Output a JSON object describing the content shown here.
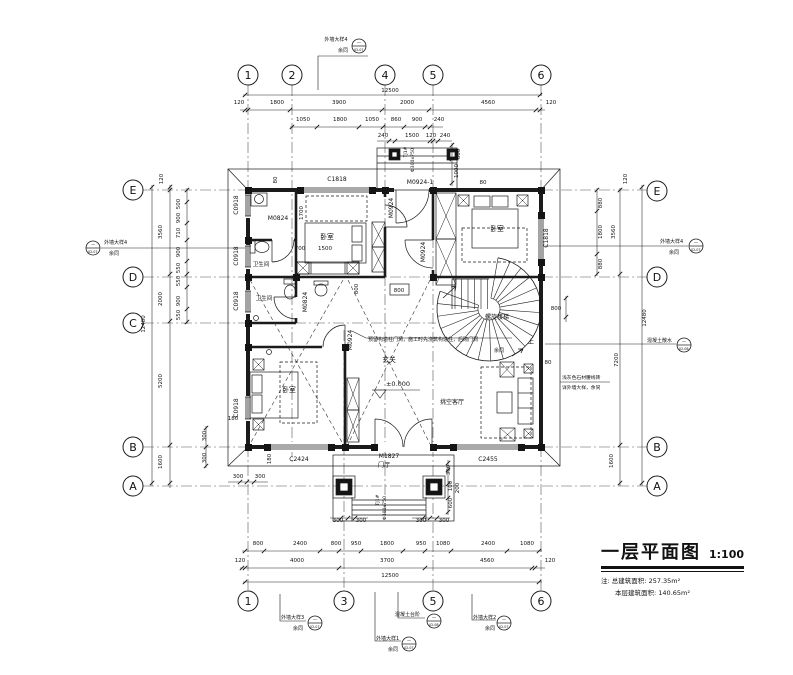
{
  "title_block": {
    "title": "一层平面图",
    "scale": "1:100",
    "note_prefix": "注:",
    "area1_label": "总建筑面积:",
    "area1_value": "257.35m²",
    "area2_label": "本层建筑面积:",
    "area2_value": "140.65m²"
  },
  "grid_bubbles": {
    "top": [
      {
        "label": "1",
        "x": 248
      },
      {
        "label": "2",
        "x": 292
      },
      {
        "label": "4",
        "x": 385
      },
      {
        "label": "5",
        "x": 433
      },
      {
        "label": "6",
        "x": 541
      }
    ],
    "bottom": [
      {
        "label": "1",
        "x": 248
      },
      {
        "label": "3",
        "x": 344
      },
      {
        "label": "5",
        "x": 433
      },
      {
        "label": "6",
        "x": 541
      }
    ],
    "left": [
      {
        "label": "E",
        "y": 190
      },
      {
        "label": "D",
        "y": 277
      },
      {
        "label": "C",
        "y": 323
      },
      {
        "label": "B",
        "y": 447
      },
      {
        "label": "A",
        "y": 486
      }
    ],
    "right": [
      {
        "label": "E",
        "y": 191
      },
      {
        "label": "D",
        "y": 277
      },
      {
        "label": "B",
        "y": 447
      },
      {
        "label": "A",
        "y": 486
      }
    ]
  },
  "rooms": [
    {
      "t": "卧室",
      "x": 327,
      "y": 239
    },
    {
      "t": "卧室",
      "x": 497,
      "y": 231
    },
    {
      "t": "卧室",
      "x": 289,
      "y": 392
    },
    {
      "t": "卫生间",
      "x": 261,
      "y": 266,
      "s": 5.5
    },
    {
      "t": "卫生间",
      "x": 264,
      "y": 300,
      "s": 5.5
    },
    {
      "t": "螺旋楼梯",
      "x": 497,
      "y": 319,
      "s": 6
    },
    {
      "t": "玄关",
      "x": 389,
      "y": 362
    },
    {
      "t": "±0.000",
      "x": 398,
      "y": 386,
      "s": 6.5
    },
    {
      "t": "挑空客厅",
      "x": 452,
      "y": 404,
      "s": 6
    },
    {
      "t": "门厅",
      "x": 384,
      "y": 467,
      "s": 6
    },
    {
      "t": "上",
      "x": 531,
      "y": 344,
      "s": 6
    }
  ],
  "openings": [
    {
      "t": "C1818",
      "x": 337,
      "y": 181
    },
    {
      "t": "M0924-1",
      "x": 420,
      "y": 184
    },
    {
      "t": "C0918",
      "x": 238,
      "y": 205,
      "r": -90
    },
    {
      "t": "C0918",
      "x": 238,
      "y": 256,
      "r": -90
    },
    {
      "t": "C0918",
      "x": 238,
      "y": 301,
      "r": -90
    },
    {
      "t": "C0918",
      "x": 238,
      "y": 408,
      "r": -90
    },
    {
      "t": "M0824",
      "x": 278,
      "y": 220
    },
    {
      "t": "M0824",
      "x": 307,
      "y": 302,
      "r": -90
    },
    {
      "t": "M0924",
      "x": 393,
      "y": 208,
      "r": -90
    },
    {
      "t": "M0924",
      "x": 425,
      "y": 252,
      "r": -90
    },
    {
      "t": "M0924",
      "x": 352,
      "y": 340,
      "r": -90
    },
    {
      "t": "C1818",
      "x": 548,
      "y": 238,
      "r": -90
    },
    {
      "t": "C2424",
      "x": 299,
      "y": 461
    },
    {
      "t": "M1827",
      "x": 389,
      "y": 458
    },
    {
      "t": "C2455",
      "x": 488,
      "y": 461
    }
  ],
  "dimensions": {
    "top": [
      {
        "t": "12500",
        "x": 390,
        "y": 92
      },
      {
        "t": "120",
        "x": 239,
        "y": 104
      },
      {
        "t": "1800",
        "x": 277,
        "y": 104
      },
      {
        "t": "3900",
        "x": 339,
        "y": 104
      },
      {
        "t": "2000",
        "x": 407,
        "y": 104
      },
      {
        "t": "4560",
        "x": 488,
        "y": 104
      },
      {
        "t": "120",
        "x": 551,
        "y": 104
      },
      {
        "t": "1050",
        "x": 303,
        "y": 121
      },
      {
        "t": "1800",
        "x": 340,
        "y": 121
      },
      {
        "t": "1050",
        "x": 372,
        "y": 121
      },
      {
        "t": "860",
        "x": 396,
        "y": 121
      },
      {
        "t": "900",
        "x": 417,
        "y": 121
      },
      {
        "t": "240",
        "x": 439,
        "y": 121
      },
      {
        "t": "240",
        "x": 383,
        "y": 137
      },
      {
        "t": "1500",
        "x": 412,
        "y": 137
      },
      {
        "t": "120",
        "x": 431,
        "y": 137
      },
      {
        "t": "240",
        "x": 445,
        "y": 137
      },
      {
        "t": "600",
        "x": 460,
        "y": 154,
        "r": -90
      },
      {
        "t": "1000",
        "x": 458,
        "y": 171,
        "r": -90
      },
      {
        "t": "TJ1#",
        "x": 407,
        "y": 152,
        "r": -90,
        "s": 4.6
      },
      {
        "t": "Φ300x750",
        "x": 414,
        "y": 160,
        "r": -90,
        "s": 4.6
      },
      {
        "t": "80",
        "x": 277,
        "y": 180,
        "r": -90
      },
      {
        "t": "80",
        "x": 483,
        "y": 184
      }
    ],
    "left": [
      {
        "t": "120",
        "x": 163,
        "y": 179,
        "r": -90
      },
      {
        "t": "3560",
        "x": 162,
        "y": 232,
        "r": -90
      },
      {
        "t": "2000",
        "x": 162,
        "y": 299,
        "r": -90
      },
      {
        "t": "5200",
        "x": 162,
        "y": 381,
        "r": -90
      },
      {
        "t": "12480",
        "x": 145,
        "y": 324,
        "r": -90
      },
      {
        "t": "1600",
        "x": 162,
        "y": 462,
        "r": -90
      },
      {
        "t": "500",
        "x": 180,
        "y": 204,
        "r": -90
      },
      {
        "t": "900",
        "x": 180,
        "y": 218,
        "r": -90
      },
      {
        "t": "710",
        "x": 180,
        "y": 233,
        "r": -90
      },
      {
        "t": "900",
        "x": 180,
        "y": 252,
        "r": -90
      },
      {
        "t": "550",
        "x": 180,
        "y": 268,
        "r": -90
      },
      {
        "t": "550",
        "x": 180,
        "y": 281,
        "r": -90
      },
      {
        "t": "900",
        "x": 180,
        "y": 301,
        "r": -90
      },
      {
        "t": "550",
        "x": 180,
        "y": 315,
        "r": -90
      },
      {
        "t": "300",
        "x": 206,
        "y": 436,
        "r": -90
      },
      {
        "t": "300",
        "x": 206,
        "y": 458,
        "r": -90
      },
      {
        "t": "180",
        "x": 233,
        "y": 420
      },
      {
        "t": "180",
        "x": 271,
        "y": 459,
        "r": -90
      },
      {
        "t": "300",
        "x": 238,
        "y": 478
      },
      {
        "t": "300",
        "x": 260,
        "y": 478
      }
    ],
    "right": [
      {
        "t": "120",
        "x": 627,
        "y": 179,
        "r": -90
      },
      {
        "t": "880",
        "x": 602,
        "y": 203,
        "r": -90
      },
      {
        "t": "1800",
        "x": 602,
        "y": 232,
        "r": -90
      },
      {
        "t": "880",
        "x": 602,
        "y": 264,
        "r": -90
      },
      {
        "t": "3560",
        "x": 615,
        "y": 232,
        "r": -90
      },
      {
        "t": "7200",
        "x": 618,
        "y": 360,
        "r": -90
      },
      {
        "t": "12480",
        "x": 646,
        "y": 318,
        "r": -90
      },
      {
        "t": "1600",
        "x": 613,
        "y": 461,
        "r": -90
      },
      {
        "t": "800",
        "x": 556,
        "y": 310
      },
      {
        "t": "80",
        "x": 548,
        "y": 364
      }
    ],
    "bottom": [
      {
        "t": "800",
        "x": 258,
        "y": 545
      },
      {
        "t": "2400",
        "x": 300,
        "y": 545
      },
      {
        "t": "800",
        "x": 336,
        "y": 545
      },
      {
        "t": "950",
        "x": 356,
        "y": 545
      },
      {
        "t": "1800",
        "x": 387,
        "y": 545
      },
      {
        "t": "950",
        "x": 421,
        "y": 545
      },
      {
        "t": "1080",
        "x": 443,
        "y": 545
      },
      {
        "t": "2400",
        "x": 488,
        "y": 545
      },
      {
        "t": "1080",
        "x": 527,
        "y": 545
      },
      {
        "t": "120",
        "x": 240,
        "y": 562
      },
      {
        "t": "4000",
        "x": 297,
        "y": 562
      },
      {
        "t": "3700",
        "x": 387,
        "y": 562
      },
      {
        "t": "4560",
        "x": 487,
        "y": 562
      },
      {
        "t": "120",
        "x": 550,
        "y": 562
      },
      {
        "t": "12500",
        "x": 390,
        "y": 577
      },
      {
        "t": "300",
        "x": 338,
        "y": 522
      },
      {
        "t": "300",
        "x": 361,
        "y": 522
      },
      {
        "t": "300",
        "x": 421,
        "y": 522
      },
      {
        "t": "300",
        "x": 444,
        "y": 522
      },
      {
        "t": "300",
        "x": 450,
        "y": 470,
        "r": -90
      },
      {
        "t": "100",
        "x": 452,
        "y": 486,
        "r": -90
      },
      {
        "t": "200",
        "x": 459,
        "y": 488,
        "r": -90
      },
      {
        "t": "600",
        "x": 452,
        "y": 503,
        "r": -90
      },
      {
        "t": "TJ1#",
        "x": 379,
        "y": 500,
        "r": -90,
        "s": 4.6
      },
      {
        "t": "Φ300x750",
        "x": 386,
        "y": 508,
        "r": -90,
        "s": 4.6
      }
    ],
    "interior": [
      {
        "t": "1700",
        "x": 303,
        "y": 213,
        "r": -90
      },
      {
        "t": "700",
        "x": 300,
        "y": 250
      },
      {
        "t": "1500",
        "x": 325,
        "y": 250
      },
      {
        "t": "800",
        "x": 358,
        "y": 289,
        "r": -90
      },
      {
        "t": "800",
        "x": 399,
        "y": 292
      }
    ]
  },
  "notes": {
    "center_note": "预留构造柱门洞，施工时先浇筑构造柱，后砌门洞",
    "center_note_sub": "余同",
    "right_material_1": "浅灰色石材腰线砖",
    "right_material_2": "详外墙大样，余同"
  },
  "callouts": [
    {
      "t1": "外墙大样4",
      "t2": "余同",
      "t1x": 336,
      "t1y": 41,
      "t2x": 343,
      "t2y": 52,
      "bx": 359,
      "by": 46,
      "code": "JD-07",
      "anchor": "middle"
    },
    {
      "t1": "外墙大样4",
      "t2": "余同",
      "t1x": 104,
      "t1y": 244,
      "t2x": 109,
      "t2y": 255,
      "bx": 93,
      "by": 248,
      "code": "JD-07",
      "anchor": "start"
    },
    {
      "t1": "外墙大样4",
      "t2": "余同",
      "t1x": 660,
      "t1y": 243,
      "t2x": 669,
      "t2y": 254,
      "bx": 696,
      "by": 246,
      "code": "JD-07",
      "anchor": "start"
    },
    {
      "t1": "混凝土散水",
      "t2": "",
      "t1x": 647,
      "t1y": 342,
      "t2x": 0,
      "t2y": 0,
      "bx": 684,
      "by": 345,
      "code": "JD-08",
      "anchor": "start"
    },
    {
      "t1": "外墙大样3",
      "t2": "余同",
      "t1x": 281,
      "t1y": 619,
      "t2x": 293,
      "t2y": 630,
      "bx": 315,
      "by": 623,
      "code": "JD-07",
      "anchor": "start"
    },
    {
      "t1": "混凝土台阶",
      "t2": "",
      "t1x": 395,
      "t1y": 616,
      "t2x": 0,
      "t2y": 0,
      "bx": 434,
      "by": 621,
      "code": "JD-08",
      "anchor": "start"
    },
    {
      "t1": "外墙大样1",
      "t2": "余同",
      "t1x": 376,
      "t1y": 640,
      "t2x": 388,
      "t2y": 651,
      "bx": 409,
      "by": 644,
      "code": "JD-07",
      "anchor": "start"
    },
    {
      "t1": "外墙大样2",
      "t2": "余同",
      "t1x": 473,
      "t1y": 619,
      "t2x": 485,
      "t2y": 630,
      "bx": 504,
      "by": 623,
      "code": "JD-07",
      "anchor": "start"
    }
  ],
  "colors": {
    "line": "#1b1b1b",
    "grid": "#555",
    "bg": "#ffffff"
  }
}
